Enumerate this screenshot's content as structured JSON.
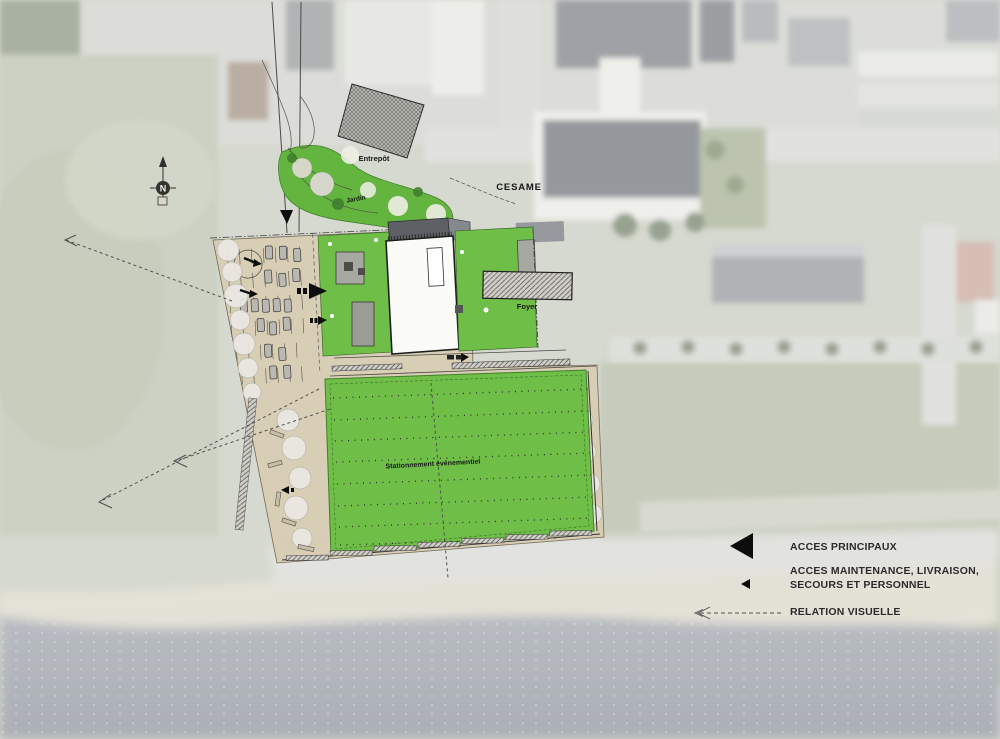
{
  "plan": {
    "labels": {
      "entrepot": "Entrepôt",
      "jardin": "Jardin",
      "cesame": "CESAME",
      "foyer": "Foyer",
      "stationnement": "Stationnement événementiel",
      "north": "N"
    }
  },
  "legend": {
    "items": [
      {
        "id": "acces-principaux",
        "label": "ACCES PRINCIPAUX"
      },
      {
        "id": "acces-maintenance",
        "label_line1": "ACCES MAINTENANCE, LIVRAISON,",
        "label_line2": "SECOURS ET PERSONNEL"
      },
      {
        "id": "relation-visuelle",
        "label": "RELATION VISUELLE"
      }
    ]
  },
  "colors": {
    "plan_green": "#6fbe48",
    "plan_beige": "#d8ccb4",
    "arrow_black": "#0d0d0d",
    "dashed_gray": "#4f4f4f",
    "water": "#8f949c",
    "legend_text": "#2b2b2b"
  }
}
